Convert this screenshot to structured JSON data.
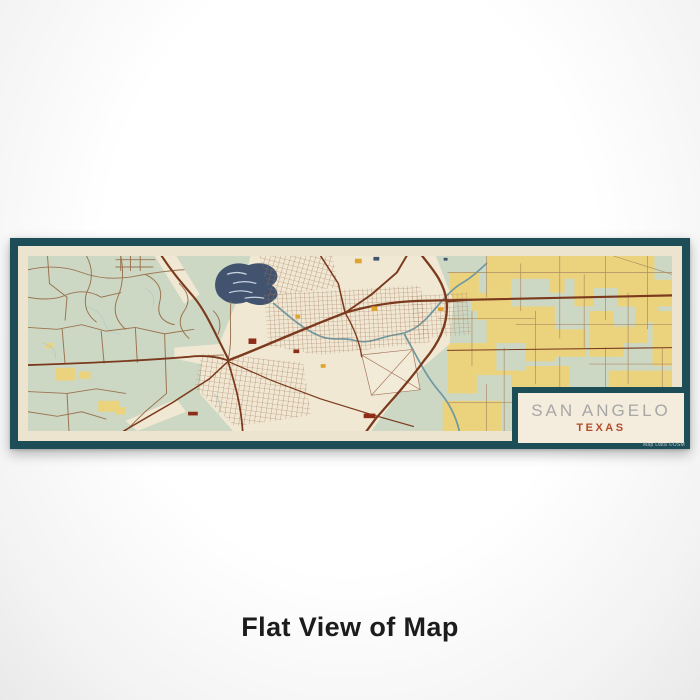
{
  "product": {
    "title": "SAN ANGELO",
    "subtitle": "TEXAS",
    "attribution": "Map Data ©OSM",
    "caption": "Flat View of Map"
  },
  "map": {
    "style": "woodblock",
    "depicted_city": "San Angelo, Texas street map",
    "features": [
      "rural-road-network-west",
      "lake-with-islands",
      "city-street-grid",
      "highway-loop-east",
      "farmland-parcels-east",
      "river-branches"
    ]
  },
  "colors": {
    "frame_teal": "#1d4d57",
    "paper_cream": "#ece4cf",
    "map_sage": "#ccd8c4",
    "field_yellow": "#ebd37e",
    "urban_cream": "#f0e8d3",
    "rural_road_brown": "#9b7350",
    "highway_brown": "#7b3a1d",
    "city_grid_brown": "#a3745a",
    "farm_grid_tan": "#ad8a62",
    "water_navy": "#41536f",
    "river_teal": "#6f99a3",
    "title_gray": "#a7a7a5",
    "subtitle_rust": "#b54a2b",
    "caption_black": "#1c1c1c"
  }
}
